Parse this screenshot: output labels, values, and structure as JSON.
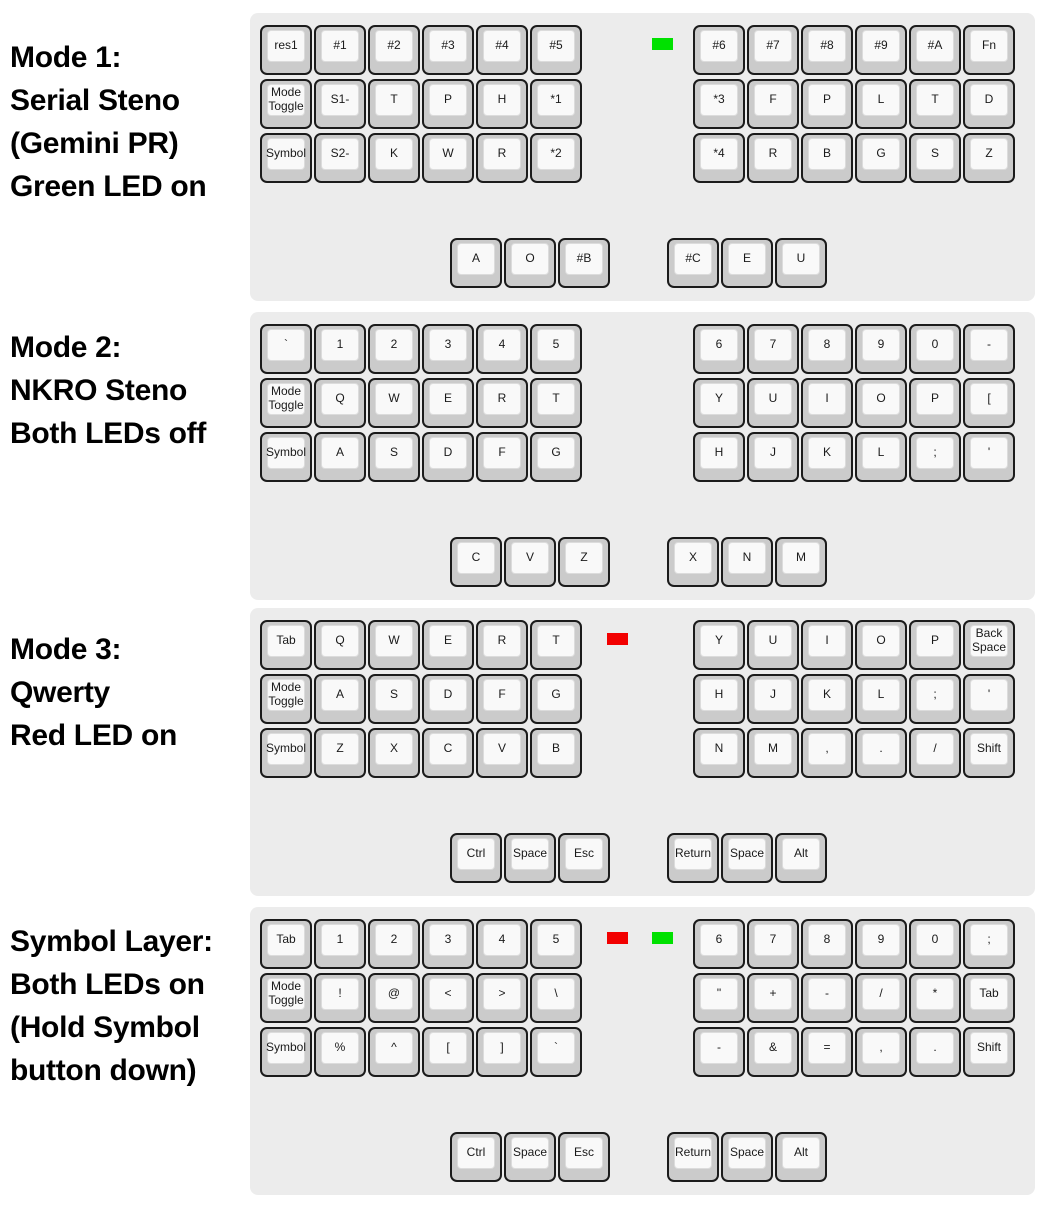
{
  "figure_title": "Steno keyboard mode layers diagram",
  "colors": {
    "panel_bg": "#ececec",
    "key_base": "#cbcbcb",
    "key_border": "#1b1b1b",
    "key_top": "#f9f9f9",
    "key_top_border": "#dcdcdc",
    "led_red": "#f20000",
    "led_green": "#00e100",
    "label_text": "#000000"
  },
  "modes": [
    {
      "label": "Mode 1:\nSerial Steno\n(Gemini PR)\nGreen LED on",
      "leds": {
        "red": false,
        "green": true
      },
      "left_main": [
        [
          "res1",
          "#1",
          "#2",
          "#3",
          "#4",
          "#5"
        ],
        [
          "Mode Toggle",
          "S1-",
          "T",
          "P",
          "H",
          "*1"
        ],
        [
          "Symbol",
          "S2-",
          "K",
          "W",
          "R",
          "*2"
        ]
      ],
      "right_main": [
        [
          "#6",
          "#7",
          "#8",
          "#9",
          "#A",
          "Fn"
        ],
        [
          "*3",
          "F",
          "P",
          "L",
          "T",
          "D"
        ],
        [
          "*4",
          "R",
          "B",
          "G",
          "S",
          "Z"
        ]
      ],
      "left_thumb": [
        "A",
        "O",
        "#B"
      ],
      "right_thumb": [
        "#C",
        "E",
        "U"
      ]
    },
    {
      "label": "Mode 2:\nNKRO Steno\nBoth LEDs off",
      "leds": {
        "red": false,
        "green": false
      },
      "left_main": [
        [
          "`",
          "1",
          "2",
          "3",
          "4",
          "5"
        ],
        [
          "Mode Toggle",
          "Q",
          "W",
          "E",
          "R",
          "T"
        ],
        [
          "Symbol",
          "A",
          "S",
          "D",
          "F",
          "G"
        ]
      ],
      "right_main": [
        [
          "6",
          "7",
          "8",
          "9",
          "0",
          "-"
        ],
        [
          "Y",
          "U",
          "I",
          "O",
          "P",
          "["
        ],
        [
          "H",
          "J",
          "K",
          "L",
          ";",
          "'"
        ]
      ],
      "left_thumb": [
        "C",
        "V",
        "Z"
      ],
      "right_thumb": [
        "X",
        "N",
        "M"
      ]
    },
    {
      "label": "Mode 3:\nQwerty\nRed LED on",
      "leds": {
        "red": true,
        "green": false
      },
      "left_main": [
        [
          "Tab",
          "Q",
          "W",
          "E",
          "R",
          "T"
        ],
        [
          "Mode Toggle",
          "A",
          "S",
          "D",
          "F",
          "G"
        ],
        [
          "Symbol",
          "Z",
          "X",
          "C",
          "V",
          "B"
        ]
      ],
      "right_main": [
        [
          "Y",
          "U",
          "I",
          "O",
          "P",
          "Back Space"
        ],
        [
          "H",
          "J",
          "K",
          "L",
          ";",
          "'"
        ],
        [
          "N",
          "M",
          ",",
          ".",
          "/",
          "Shift"
        ]
      ],
      "left_thumb": [
        "Ctrl",
        "Space",
        "Esc"
      ],
      "right_thumb": [
        "Return",
        "Space",
        "Alt"
      ]
    },
    {
      "label": "Symbol Layer:\nBoth LEDs on\n(Hold Symbol\nbutton down)",
      "leds": {
        "red": true,
        "green": true
      },
      "left_main": [
        [
          "Tab",
          "1",
          "2",
          "3",
          "4",
          "5"
        ],
        [
          "Mode Toggle",
          "!",
          "@",
          "<",
          ">",
          "\\"
        ],
        [
          "Symbol",
          "%",
          "^",
          "[",
          "]",
          "`"
        ]
      ],
      "right_main": [
        [
          "6",
          "7",
          "8",
          "9",
          "0",
          ";"
        ],
        [
          "\"",
          "+",
          "-",
          "/",
          "*",
          "Tab"
        ],
        [
          "-",
          "&",
          "=",
          ",",
          ".",
          "Shift"
        ]
      ],
      "left_thumb": [
        "Ctrl",
        "Space",
        "Esc"
      ],
      "right_thumb": [
        "Return",
        "Space",
        "Alt"
      ]
    }
  ]
}
